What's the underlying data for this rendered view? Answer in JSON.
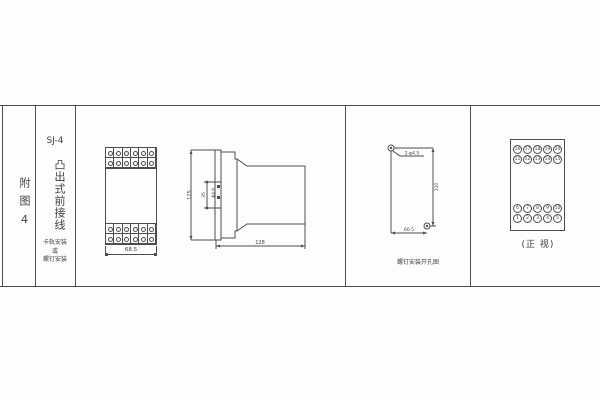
{
  "title_block": {
    "fig_label": "附图4",
    "model": "SJ-4",
    "type_label": "凸出式前接线",
    "mount_note": [
      "卡轨安装",
      "或",
      "螺钉安装"
    ]
  },
  "front_view": {
    "width_dim": "68.5"
  },
  "side_view": {
    "height_dim": "125",
    "hole_spacing_dim": "35",
    "hole_dia_label": "Φ4.8",
    "depth_dim": "128"
  },
  "drill_view": {
    "holes_label": "2-φ4.5",
    "vertical_dim": "110",
    "horizontal_dim": "60.5",
    "caption": "螺钉安装开孔图"
  },
  "terminal_view": {
    "caption": "(正 视)",
    "top_rows": [
      [
        "16",
        "17",
        "18",
        "19",
        "20"
      ],
      [
        "11",
        "12",
        "13",
        "14",
        "15"
      ]
    ],
    "bottom_rows": [
      [
        "6",
        "7",
        "8",
        "9",
        "10"
      ],
      [
        "1",
        "2",
        "3",
        "4",
        "5"
      ]
    ]
  },
  "colors": {
    "line": "#4d4d4d",
    "paper": "#fdfdfd"
  }
}
